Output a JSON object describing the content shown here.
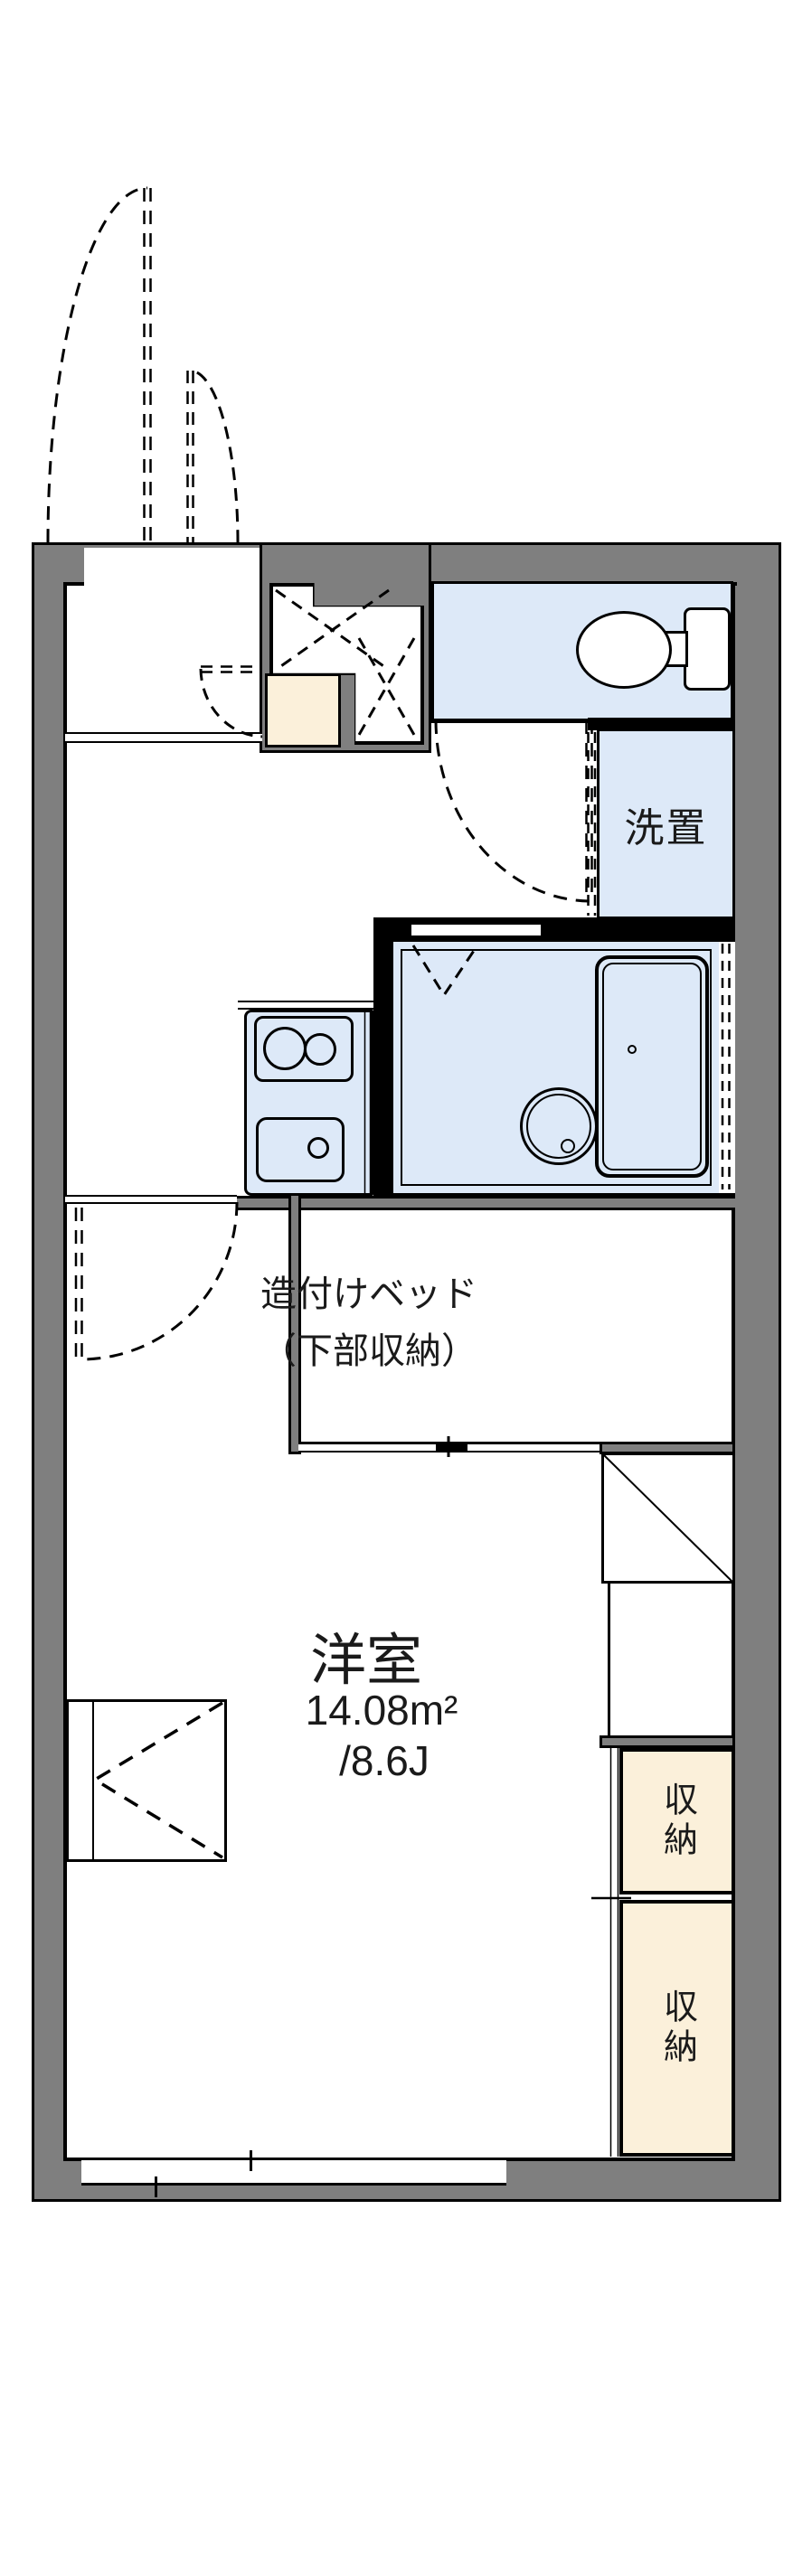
{
  "plan": {
    "type": "apartment-floor-plan",
    "labels": {
      "washer_room": "洗置",
      "bed_line1": "造付けベッド",
      "bed_line2": "（下部収納）",
      "main_room": "洋室",
      "main_room_area_m2": "14.08m²",
      "main_room_area_jo": "/8.6J",
      "storage_upper": "収納",
      "storage_lower": "収納"
    },
    "colors": {
      "wall": "#7f7f7f",
      "water_unit_fill": "#dde9f8",
      "storage_fill": "#fbf0da",
      "line": "#000000",
      "background": "#ffffff"
    }
  }
}
